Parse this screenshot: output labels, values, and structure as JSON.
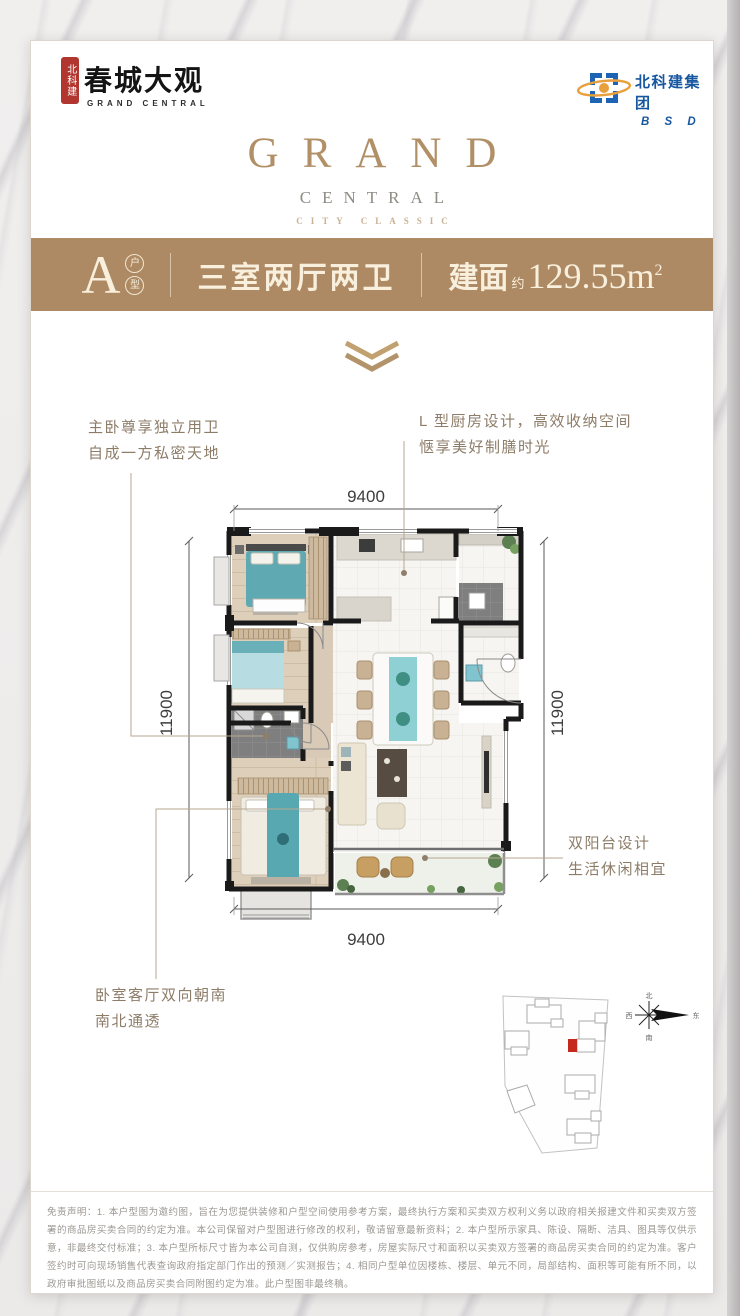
{
  "header": {
    "seal_chars": "北科建",
    "brand_name": "春城大观",
    "brand_sub": "GRAND CENTRAL",
    "developer_name": "北科建集团",
    "developer_sub": "B S D"
  },
  "brand_center": {
    "title": "GRAND",
    "subtitle": "CENTRAL",
    "tagline": "CITY CLASSIC"
  },
  "banner": {
    "unit": "A",
    "unit_tag_chars": [
      "户",
      "型"
    ],
    "layout": "三室两厅两卫",
    "area_label": "建面",
    "area_approx": "约",
    "area_value": "129.55m",
    "area_sup": "2",
    "bg_color": "#ae8a64"
  },
  "annotations": {
    "master_bath": [
      "主卧尊享独立用卫",
      "自成一方私密天地"
    ],
    "kitchen": [
      "L 型厨房设计，高效收纳空间",
      "惬享美好制膳时光"
    ],
    "balcony": [
      "双阳台设计",
      "生活休闲相宜"
    ],
    "orientation": [
      "卧室客厅双向朝南",
      "南北通透"
    ]
  },
  "floorplan": {
    "dim_top": "9400",
    "dim_bottom": "9400",
    "dim_left": "11900",
    "dim_right": "11900",
    "accent_teal": "#5fa9b2",
    "wall_color": "#1a1a1a"
  },
  "sitemap": {
    "compass": {
      "n": "北",
      "s": "南",
      "e": "东",
      "w": "西"
    },
    "highlight_color": "#c5281c"
  },
  "disclaimer": "免责声明：1. 本户型图为邀约图，旨在为您提供装修和户型空间使用参考方案，最终执行方案和买卖双方权利义务以政府相关报建文件和买卖双方签署的商品房买卖合同的约定为准。本公司保留对户型图进行修改的权利，敬请留意最新资料；2. 本户型所示家具、陈设、隔断、洁具、图具等仅供示意，非最终交付标准；3. 本户型所标尺寸皆为本公司自测，仅供购房参考，房屋实际尺寸和面积以买卖双方签署的商品房买卖合同的约定为准。客户签约时可向现场销售代表查询政府指定部门作出的预测／实测报告；4. 相同户型单位因楼栋、楼层、单元不同，局部结构、面积等可能有所不同，以政府审批图纸以及商品房买卖合同附图约定为准。此户型图非最终稿。"
}
